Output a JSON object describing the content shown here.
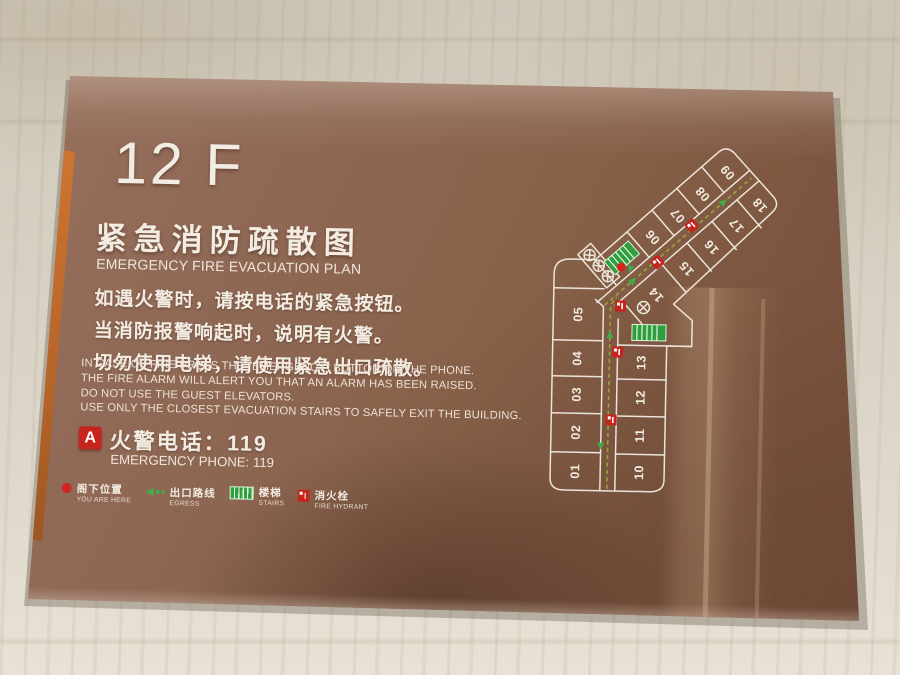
{
  "sign": {
    "floor": "12 F",
    "title_zh": "紧急消防疏散图",
    "title_en": "EMERGENCY FIRE EVACUATION PLAN",
    "instructions_zh": [
      "如遇火警时，请按电话的紧急按钮。",
      "当消防报警响起时，说明有火警。",
      "切勿使用电梯，请使用紧急出口疏散。"
    ],
    "instructions_en": [
      "IN CASE OF FIRE PRESS THE  \"EMERGENCY\"  BUTTON ON THE PHONE.",
      "THE FIRE ALARM WILL ALERT YOU THAT AN ALARM HAS BEEN RAISED.",
      "DO NOT USE THE GUEST ELEVATORS.",
      "USE ONLY THE CLOSEST EVACUATION STAIRS TO SAFELY EXIT THE BUILDING."
    ],
    "phone": {
      "icon_label": "A",
      "zh": "火警电话：119",
      "en": "EMERGENCY PHONE: 119"
    },
    "legend": [
      {
        "icon": "you-are-here-dot",
        "zh": "阁下位置",
        "en": "YOU ARE HERE"
      },
      {
        "icon": "egress-arrow",
        "zh": "出口路线",
        "en": "EGRESS"
      },
      {
        "icon": "stairs",
        "zh": "楼梯",
        "en": "STAIRS"
      },
      {
        "icon": "fire-hydrant",
        "zh": "消火栓",
        "en": "FIRE HYDRANT"
      }
    ],
    "plan": {
      "rooms": [
        "01",
        "02",
        "03",
        "04",
        "05",
        "06",
        "07",
        "08",
        "09",
        "10",
        "11",
        "12",
        "13",
        "14",
        "15",
        "16",
        "17",
        "18"
      ]
    },
    "colors": {
      "panel": "#8d6753",
      "panel_dark": "#6e4a37",
      "stripe_orange": "#c9722e",
      "text_light": "#f3ece3",
      "plan_line": "#f2ece2",
      "route_olive": "#9aa03a",
      "egress_green": "#3fae4a",
      "stairs_green": "#2f9e3c",
      "hydrant_red": "#c6251f",
      "marker_red": "#d2251f",
      "wall_beige": "#d8d2c5"
    }
  }
}
